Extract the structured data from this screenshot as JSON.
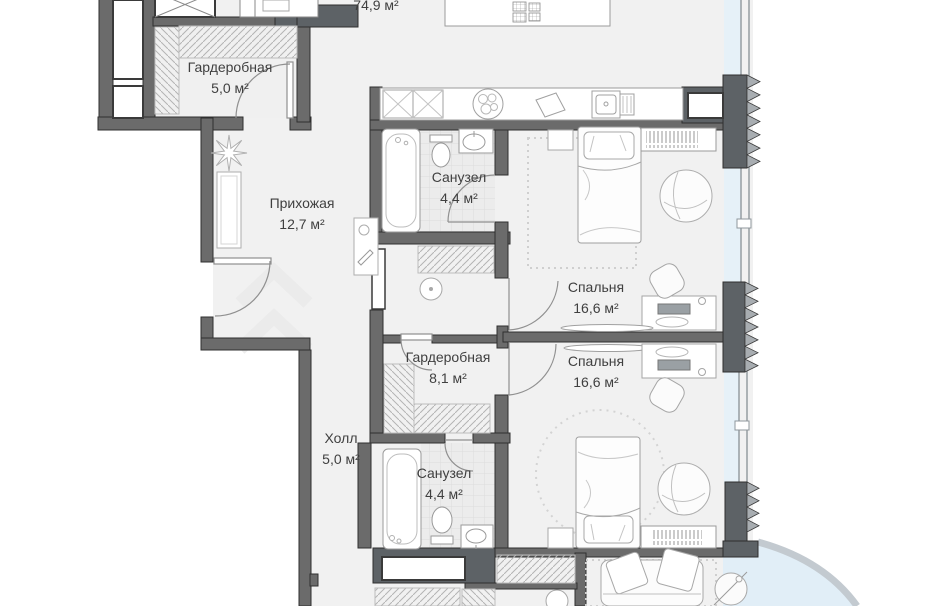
{
  "plan": {
    "living_area_label": "74,9 м²",
    "rooms": [
      {
        "name": "Гардеробная",
        "area": "5,0 м²"
      },
      {
        "name": "Прихожая",
        "area": "12,7 м²"
      },
      {
        "name": "Санузел",
        "area": "4,4 м²"
      },
      {
        "name": "Спальня",
        "area": "16,6 м²"
      },
      {
        "name": "Гардеробная",
        "area": "8,1 м²"
      },
      {
        "name": "Спальня",
        "area": "16,6 м²"
      },
      {
        "name": "Холл",
        "area": "5,0 м²"
      },
      {
        "name": "Санузел",
        "area": "4,4 м²"
      }
    ],
    "colors": {
      "wall": "#6b6b6b",
      "wall_dark": "#5d6266",
      "insulation": "#a8adb1",
      "floor": "#f1f1f1",
      "tile": "#ececec",
      "glazing_tint": "#e6f1f8",
      "balcony_band": "#c3cad0",
      "label_text": "#404040"
    }
  }
}
